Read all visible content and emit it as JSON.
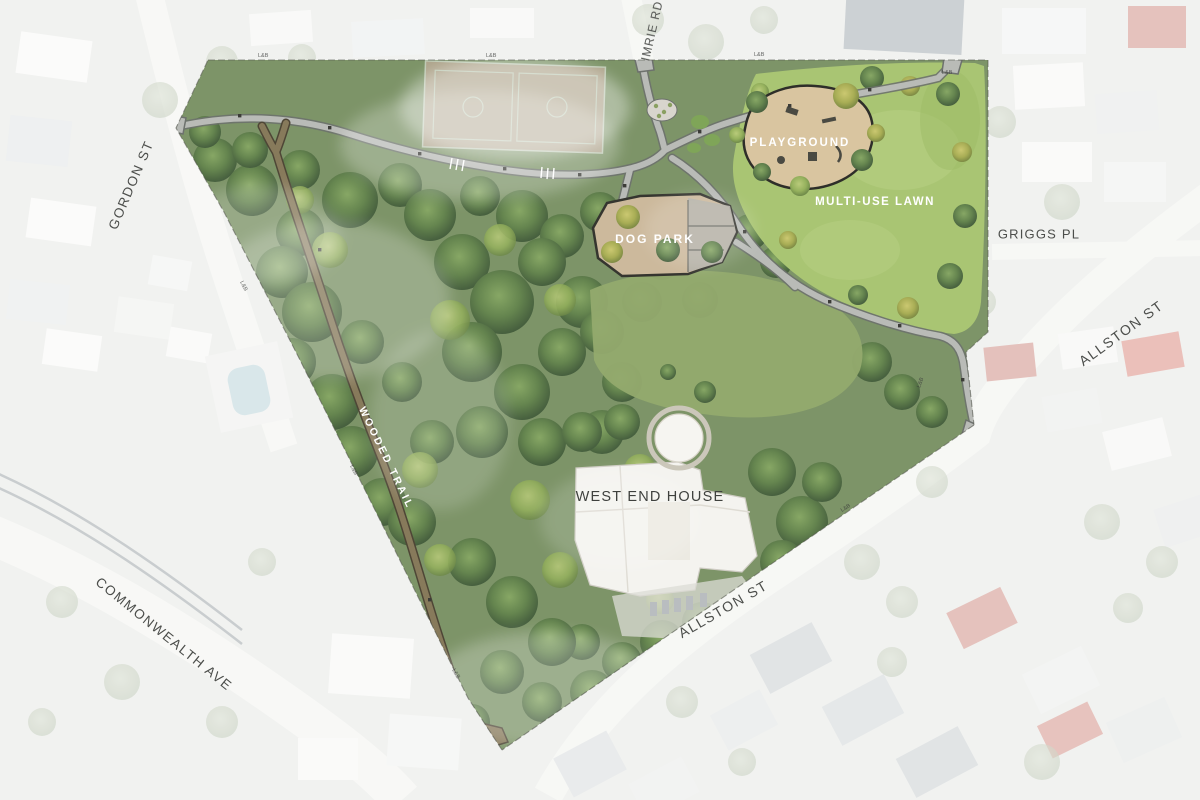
{
  "plan": {
    "areas": {
      "playground": {
        "label": "PLAYGROUND"
      },
      "lawn": {
        "label": "MULTI-USE LAWN"
      },
      "dog_park": {
        "label": "DOG PARK"
      },
      "trail": {
        "label": "WOODED TRAIL"
      },
      "building": {
        "label": "WEST END HOUSE"
      }
    },
    "streets": {
      "gordon": {
        "label": "GORDON ST"
      },
      "imrie": {
        "label": "IMRIE RD"
      },
      "griggs": {
        "label": "GRIGGS PL"
      },
      "allston_east": {
        "label": "ALLSTON ST"
      },
      "allston_south": {
        "label": "ALLSTON ST"
      },
      "commonwealth": {
        "label": "COMMONWEALTH AVE"
      }
    },
    "boundary_marker": "L&B",
    "palette": {
      "lawn_green": "#a9c573",
      "canopy_green": "#55754c",
      "playground_tan": "#d9c5a0",
      "dog_park_tan": "#ccb99c",
      "trail_brown": "#877a5b",
      "path_gray": "#b9bbb7",
      "court_pink": "#dfb3ae",
      "label_white": "#ffffff",
      "label_gray": "#4c4e4b"
    }
  }
}
